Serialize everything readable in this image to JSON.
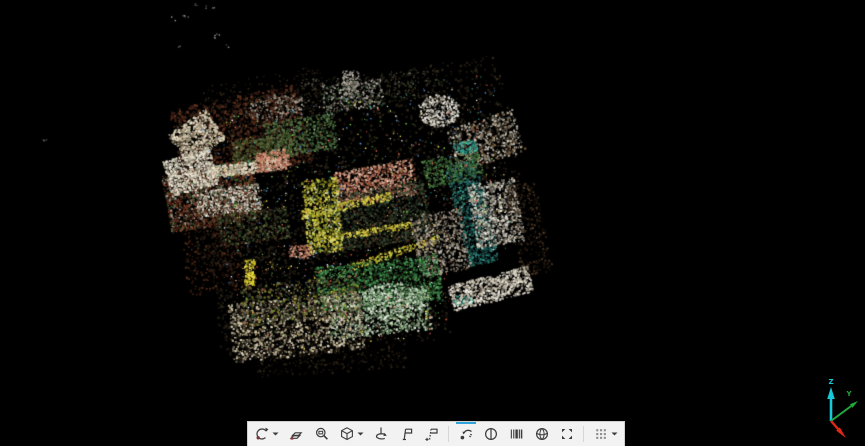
{
  "app": {
    "background": "#000000"
  },
  "toolbar": {
    "background": "#f2f2f2",
    "border_color": "#cfcfcf",
    "accent_color": "#2ea3dc",
    "icon_color": "#3c3c3c",
    "groups": [
      {
        "items": [
          {
            "name": "orbit",
            "dropdown": true,
            "selected": false
          },
          {
            "name": "free-orbit",
            "dropdown": false,
            "selected": false
          },
          {
            "name": "zoom-window",
            "dropdown": false,
            "selected": false
          },
          {
            "name": "view-cube",
            "dropdown": true,
            "selected": false
          },
          {
            "name": "pivot",
            "dropdown": false,
            "selected": false
          },
          {
            "name": "tag",
            "dropdown": false,
            "selected": false
          },
          {
            "name": "tag-add",
            "dropdown": false,
            "selected": false
          }
        ]
      },
      {
        "items": [
          {
            "name": "swipe",
            "dropdown": false,
            "selected": true
          },
          {
            "name": "split-view",
            "dropdown": false,
            "selected": false
          },
          {
            "name": "slices",
            "dropdown": false,
            "selected": false
          },
          {
            "name": "ball-view",
            "dropdown": false,
            "selected": false
          },
          {
            "name": "fit-corners",
            "dropdown": false,
            "selected": false
          }
        ]
      },
      {
        "items": [
          {
            "name": "grid-views",
            "dropdown": true,
            "selected": false
          }
        ]
      }
    ]
  },
  "axis_gizmo": {
    "z": {
      "label": "Z",
      "color": "#17c8d8"
    },
    "y": {
      "label": "Y",
      "color": "#22a83c"
    },
    "x": {
      "label": "",
      "color": "#e02818"
    }
  },
  "point_cloud": {
    "seed": 7,
    "outlier_colors": [
      "#6a6a66",
      "#9a9a94",
      "#4a4a46"
    ],
    "outliers": [
      [
        196,
        4
      ],
      [
        207,
        7
      ],
      [
        213,
        8
      ],
      [
        186,
        16
      ],
      [
        183,
        15
      ],
      [
        173,
        18
      ],
      [
        218,
        34
      ],
      [
        214,
        36
      ],
      [
        178,
        45
      ],
      [
        226,
        46
      ],
      [
        44,
        139
      ]
    ],
    "patches": [
      {
        "sh": "r",
        "x": 350,
        "y": 165,
        "w": 330,
        "h": 170,
        "a": -10,
        "n": 2200,
        "s": 2,
        "c": [
          "#241f14",
          "#2e2718",
          "#1c1812",
          "#342b1b"
        ]
      },
      {
        "sh": "r",
        "x": 330,
        "y": 295,
        "w": 230,
        "h": 110,
        "a": -6,
        "n": 1100,
        "s": 2,
        "c": [
          "#241f14",
          "#2e2718",
          "#191510"
        ]
      },
      {
        "sh": "r",
        "x": 265,
        "y": 100,
        "w": 120,
        "h": 50,
        "a": -10,
        "n": 300,
        "s": 1.5,
        "c": [
          "#1b160e",
          "#2b2214",
          "#3a2e1c"
        ]
      },
      {
        "sh": "r",
        "x": 370,
        "y": 88,
        "w": 140,
        "h": 30,
        "a": -5,
        "n": 320,
        "s": 1.5,
        "c": [
          "#241f14",
          "#4a4438",
          "#6a645a",
          "#2c3a24"
        ]
      },
      {
        "sh": "r",
        "x": 240,
        "y": 135,
        "w": 130,
        "h": 80,
        "a": -12,
        "n": 1500,
        "s": 2,
        "c": [
          "#3a1f16",
          "#4a2317",
          "#5a301c",
          "#2a1510",
          "#6b3a22"
        ]
      },
      {
        "sh": "r",
        "x": 210,
        "y": 195,
        "w": 90,
        "h": 60,
        "a": -10,
        "n": 1700,
        "s": 1.8,
        "c": [
          "#6b2e1e",
          "#8a4a2e",
          "#a8a092",
          "#3f5a30",
          "#5a2a1a",
          "#262014"
        ]
      },
      {
        "sh": "r",
        "x": 196,
        "y": 136,
        "w": 46,
        "h": 36,
        "a": -35,
        "n": 700,
        "s": 1.8,
        "c": [
          "#d8cdb2",
          "#efe8d2",
          "#b8ad92",
          "#8a8068"
        ]
      },
      {
        "sh": "r",
        "x": 190,
        "y": 172,
        "w": 48,
        "h": 36,
        "a": -15,
        "n": 850,
        "s": 1.8,
        "c": [
          "#e8e2d0",
          "#f5f2e6",
          "#c9c2ae",
          "#7a7464"
        ]
      },
      {
        "sh": "r",
        "x": 247,
        "y": 167,
        "w": 78,
        "h": 12,
        "a": -8,
        "n": 460,
        "s": 1.8,
        "c": [
          "#ddd4ba",
          "#efe8d2",
          "#b0a68c"
        ]
      },
      {
        "sh": "r",
        "x": 228,
        "y": 200,
        "w": 64,
        "h": 26,
        "a": -8,
        "n": 650,
        "s": 1.6,
        "c": [
          "#ddd6c4",
          "#f0ece0",
          "#99917e",
          "#55503f"
        ]
      },
      {
        "sh": "e",
        "x": 275,
        "y": 107,
        "w": 60,
        "h": 26,
        "a": -8,
        "n": 240,
        "s": 1.6,
        "c": [
          "#8a8578",
          "#b5b0a2",
          "#5a564c"
        ]
      },
      {
        "sh": "r",
        "x": 352,
        "y": 95,
        "w": 60,
        "h": 28,
        "a": -5,
        "n": 330,
        "s": 1.6,
        "c": [
          "#9a948a",
          "#c8c2b4",
          "#6a655c",
          "#3a5a3a"
        ]
      },
      {
        "sh": "r",
        "x": 350,
        "y": 82,
        "w": 16,
        "h": 24,
        "a": 0,
        "n": 150,
        "s": 1.6,
        "c": [
          "#9a948a",
          "#c8c2b4",
          "#6a655c"
        ]
      },
      {
        "sh": "e",
        "x": 438,
        "y": 110,
        "w": 42,
        "h": 32,
        "a": 0,
        "n": 430,
        "s": 1.8,
        "c": [
          "#e5e0d2",
          "#f6f3ea",
          "#b5b0a2",
          "#8a8578"
        ]
      },
      {
        "sh": "r",
        "x": 300,
        "y": 135,
        "w": 70,
        "h": 36,
        "a": -10,
        "n": 560,
        "s": 1.8,
        "c": [
          "#3d5a33",
          "#4e7040",
          "#2c4526",
          "#5d8050"
        ]
      },
      {
        "sh": "r",
        "x": 262,
        "y": 148,
        "w": 60,
        "h": 24,
        "a": -8,
        "n": 400,
        "s": 1.7,
        "c": [
          "#4a5a30",
          "#5e7040",
          "#38451f"
        ]
      },
      {
        "sh": "r",
        "x": 485,
        "y": 140,
        "w": 70,
        "h": 44,
        "a": -18,
        "n": 620,
        "s": 1.8,
        "c": [
          "#b0aa9a",
          "#d8d2c2",
          "#7a7468",
          "#4a4438",
          "#8a6a4a"
        ]
      },
      {
        "sh": "r",
        "x": 375,
        "y": 183,
        "w": 80,
        "h": 36,
        "a": -10,
        "n": 900,
        "s": 1.8,
        "c": [
          "#c08068",
          "#d9a188",
          "#a35a43",
          "#e8c0a8",
          "#8a4a36"
        ]
      },
      {
        "sh": "r",
        "x": 272,
        "y": 160,
        "w": 34,
        "h": 20,
        "a": -10,
        "n": 300,
        "s": 1.7,
        "c": [
          "#c08068",
          "#d9a188",
          "#a35a43"
        ]
      },
      {
        "sh": "e",
        "x": 300,
        "y": 251,
        "w": 28,
        "h": 14,
        "a": 0,
        "n": 170,
        "s": 1.6,
        "c": [
          "#c98d74",
          "#e0b098",
          "#a05a44"
        ]
      },
      {
        "sh": "r",
        "x": 378,
        "y": 215,
        "w": 100,
        "h": 58,
        "a": -10,
        "n": 1500,
        "s": 1.8,
        "c": [
          "#22301e",
          "#18241a",
          "#3a4a30",
          "#0e140c",
          "#4a5a42",
          "#5a3a28"
        ]
      },
      {
        "sh": "r",
        "x": 345,
        "y": 205,
        "w": 92,
        "h": 8,
        "a": -12,
        "n": 250,
        "s": 1.6,
        "c": [
          "#d6c93a",
          "#efe45c",
          "#b0a428"
        ]
      },
      {
        "sh": "r",
        "x": 362,
        "y": 232,
        "w": 100,
        "h": 7,
        "a": -10,
        "n": 230,
        "s": 1.6,
        "c": [
          "#d6c93a",
          "#efe45c",
          "#b0a428"
        ]
      },
      {
        "sh": "r",
        "x": 395,
        "y": 252,
        "w": 92,
        "h": 7,
        "a": -18,
        "n": 210,
        "s": 1.6,
        "c": [
          "#cfc235",
          "#e8de55",
          "#a89a20"
        ]
      },
      {
        "sh": "r",
        "x": 322,
        "y": 215,
        "w": 36,
        "h": 74,
        "a": -5,
        "n": 760,
        "s": 1.8,
        "c": [
          "#cfc22f",
          "#e8de55",
          "#a89a20",
          "#8a8f28",
          "#d8d890",
          "#5a6a20"
        ]
      },
      {
        "sh": "r",
        "x": 249,
        "y": 272,
        "w": 10,
        "h": 26,
        "a": 0,
        "n": 130,
        "s": 1.7,
        "c": [
          "#e8d830",
          "#f5ea60",
          "#c0b020"
        ]
      },
      {
        "sh": "r",
        "x": 472,
        "y": 212,
        "w": 32,
        "h": 104,
        "a": -14,
        "n": 900,
        "s": 1.8,
        "c": [
          "#1f5a58",
          "#2a7a74",
          "#17423f",
          "#35968c",
          "#123432"
        ]
      },
      {
        "sh": "r",
        "x": 452,
        "y": 168,
        "w": 58,
        "h": 28,
        "a": -12,
        "n": 420,
        "s": 1.7,
        "c": [
          "#3f6a3a",
          "#538a48",
          "#2c4c2a"
        ]
      },
      {
        "sh": "e",
        "x": 465,
        "y": 146,
        "w": 26,
        "h": 14,
        "a": 0,
        "n": 140,
        "s": 1.6,
        "c": [
          "#2a9a8a",
          "#45c0ae",
          "#1d6a60"
        ]
      },
      {
        "sh": "r",
        "x": 495,
        "y": 212,
        "w": 48,
        "h": 64,
        "a": -10,
        "n": 880,
        "s": 1.8,
        "c": [
          "#ddd8ca",
          "#f2efe4",
          "#b0aa9a",
          "#8a857a",
          "#6a655a"
        ]
      },
      {
        "sh": "r",
        "x": 440,
        "y": 242,
        "w": 52,
        "h": 62,
        "a": -10,
        "n": 700,
        "s": 1.8,
        "c": [
          "#9a9488",
          "#c2bcb0",
          "#6a645a",
          "#4a3a2c",
          "#b5a58a"
        ]
      },
      {
        "sh": "r",
        "x": 528,
        "y": 228,
        "w": 32,
        "h": 92,
        "a": -12,
        "n": 340,
        "s": 1.7,
        "c": [
          "#241a10",
          "#3a281a",
          "#140e08",
          "#55402a"
        ]
      },
      {
        "sh": "r",
        "x": 378,
        "y": 283,
        "w": 124,
        "h": 46,
        "a": -6,
        "n": 1400,
        "s": 1.8,
        "c": [
          "#2e6a38",
          "#3f8a48",
          "#245428",
          "#57a560",
          "#1a3c1e"
        ]
      },
      {
        "sh": "r",
        "x": 378,
        "y": 312,
        "w": 104,
        "h": 44,
        "a": -6,
        "n": 1050,
        "s": 1.8,
        "c": [
          "#9ab592",
          "#c5d8bc",
          "#6a8a64",
          "#e2ede0",
          "#44603e"
        ]
      },
      {
        "sh": "e",
        "x": 462,
        "y": 300,
        "w": 22,
        "h": 10,
        "a": 0,
        "n": 90,
        "s": 1.6,
        "c": [
          "#2a9a8a",
          "#45c0ae"
        ]
      },
      {
        "sh": "r",
        "x": 490,
        "y": 288,
        "w": 82,
        "h": 26,
        "a": -14,
        "n": 780,
        "s": 1.8,
        "c": [
          "#e2dccc",
          "#f4f0e6",
          "#c0b8a4",
          "#8a8070"
        ]
      },
      {
        "sh": "r",
        "x": 296,
        "y": 326,
        "w": 132,
        "h": 58,
        "a": -6,
        "n": 1350,
        "s": 1.9,
        "c": [
          "#cfc3a2",
          "#e5dcc0",
          "#a89a7c",
          "#6a6050",
          "#2a2418"
        ]
      },
      {
        "sh": "r",
        "x": 300,
        "y": 300,
        "w": 120,
        "h": 40,
        "a": -6,
        "n": 680,
        "s": 1.8,
        "c": [
          "#3a3226",
          "#55482f",
          "#7a6a4a",
          "#24412a",
          "#8a8f28"
        ]
      },
      {
        "sh": "r",
        "x": 330,
        "y": 360,
        "w": 150,
        "h": 24,
        "a": -4,
        "n": 280,
        "s": 1.7,
        "c": [
          "#241d12",
          "#3a2f1c",
          "#120d08"
        ]
      },
      {
        "sh": "r",
        "x": 212,
        "y": 250,
        "w": 60,
        "h": 84,
        "a": -8,
        "n": 430,
        "s": 1.7,
        "c": [
          "#3a1d12",
          "#55301c",
          "#241108"
        ]
      },
      {
        "sh": "r",
        "x": 252,
        "y": 226,
        "w": 72,
        "h": 32,
        "a": -8,
        "n": 520,
        "s": 1.7,
        "c": [
          "#2c4526",
          "#4a3020",
          "#5e7040",
          "#1c1812"
        ]
      },
      {
        "sh": "e",
        "x": 392,
        "y": 300,
        "w": 64,
        "h": 36,
        "a": 0,
        "n": 480,
        "s": 1.8,
        "c": [
          "#c5d8bc",
          "#e8f0e2",
          "#88a880",
          "#4a6a44"
        ]
      },
      {
        "sh": "r",
        "x": 360,
        "y": 185,
        "w": 300,
        "h": 180,
        "a": -10,
        "n": 520,
        "s": 1.2,
        "c": [
          "#ffffff",
          "#ffe94a",
          "#4ad0c0",
          "#ff6a50",
          "#8ae050",
          "#58a0ff"
        ]
      },
      {
        "sh": "r",
        "x": 345,
        "y": 300,
        "w": 210,
        "h": 88,
        "a": -6,
        "n": 220,
        "s": 1.2,
        "c": [
          "#ffffff",
          "#ffe94a",
          "#8ae050",
          "#ff6a50"
        ]
      }
    ]
  }
}
